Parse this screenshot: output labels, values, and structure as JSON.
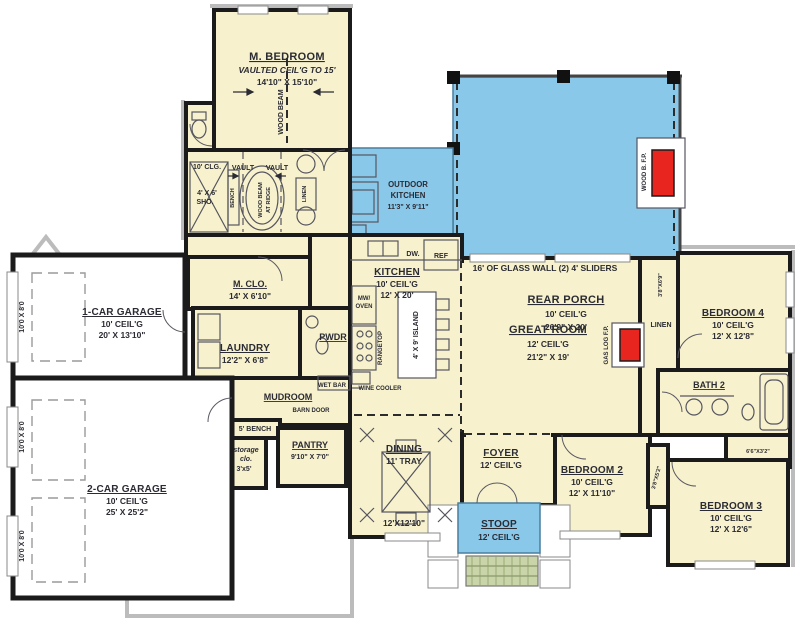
{
  "colors": {
    "room_fill": "#F7F2CD",
    "porch_fill": "#8AC8EA",
    "fireplace_red": "#E8251F",
    "wall": "#1b1b1b",
    "steps_fill": "#C9D4A9"
  },
  "rooms": {
    "m_bedroom": {
      "name": "M. BEDROOM",
      "note": "VAULTED CEIL'G TO 15'",
      "dims": "14'10\" X 15'10\""
    },
    "rear_porch": {
      "name": "REAR PORCH",
      "ceil": "10' CEIL'G",
      "dims": "26'9\" X 20'"
    },
    "outdoor_kitchen": {
      "name1": "OUTDOOR",
      "name2": "KITCHEN",
      "dims": "11'3\" X 9'11\""
    },
    "kitchen": {
      "name": "KITCHEN",
      "ceil": "10' CEIL'G",
      "dims": "12' X 20'"
    },
    "great_room": {
      "name": "GREAT ROOM",
      "ceil": "12' CEIL'G",
      "dims": "21'2\" X 19'"
    },
    "m_clo": {
      "name": "M. CLO.",
      "dims": "14' X 6'10\""
    },
    "laundry": {
      "name": "LAUNDRY",
      "dims": "12'2\" X 6'8\""
    },
    "pwdr": {
      "name": "PWDR"
    },
    "mudroom": {
      "name": "MUDROOM"
    },
    "garage1": {
      "name": "1-CAR GARAGE",
      "ceil": "10' CEIL'G",
      "dims": "20' X 13'10\""
    },
    "garage2": {
      "name": "2-CAR GARAGE",
      "ceil": "10' CEIL'G",
      "dims": "25' X 25'2\""
    },
    "pantry": {
      "name": "PANTRY",
      "dims": "9'10\" X 7'0\""
    },
    "dining": {
      "name": "DINING",
      "ceil": "11' TRAY",
      "dims": "12'X12'10\""
    },
    "foyer": {
      "name": "FOYER",
      "ceil": "12' CEIL'G"
    },
    "stoop": {
      "name": "STOOP",
      "ceil": "12' CEIL'G"
    },
    "bedroom2": {
      "name": "BEDROOM 2",
      "ceil": "10' CEIL'G",
      "dims": "12' X 11'10\""
    },
    "bedroom3": {
      "name": "BEDROOM 3",
      "ceil": "10' CEIL'G",
      "dims": "12' X 12'6\""
    },
    "bedroom4": {
      "name": "BEDROOM 4",
      "ceil": "10' CEIL'G",
      "dims": "12' X 12'8\""
    },
    "bath2": {
      "name": "BATH 2"
    }
  },
  "annotations": {
    "glass_wall": "16' OF GLASS WALL (2) 4' SLIDERS",
    "wood_beam": "WOOD BEAM",
    "wood_beam_ridge1": "WOOD BEAM",
    "wood_beam_ridge2": "AT RIDGE",
    "vault": "VAULT",
    "clg10": "10' CLG.",
    "shower1": "4' X 6'",
    "shower2": "SHO.",
    "bench": "BENCH",
    "linen": "LINEN",
    "wet_bar": "WET BAR",
    "barn_door": "BARN DOOR",
    "bench5": "5' BENCH",
    "storage1": "storage",
    "storage2": "clo.",
    "storage3": "3'x5'",
    "island": "4' X 9' ISLAND",
    "mw1": "MW/",
    "mw2": "OVEN",
    "rangetop": "RANGETOP",
    "wine_cooler": "WINE COOLER",
    "dw": "DW.",
    "ref": "REF",
    "gas_fp": "GAS LOG F.P.",
    "wood_fp": "WOOD B. F.P.",
    "garage_door": "10'0 X 8'0",
    "closet_38_69": "3'8\"X6'9\"",
    "closet_66_32": "6'6\"X3'2\"",
    "closet_38_52": "3'8\"X5'2\""
  }
}
